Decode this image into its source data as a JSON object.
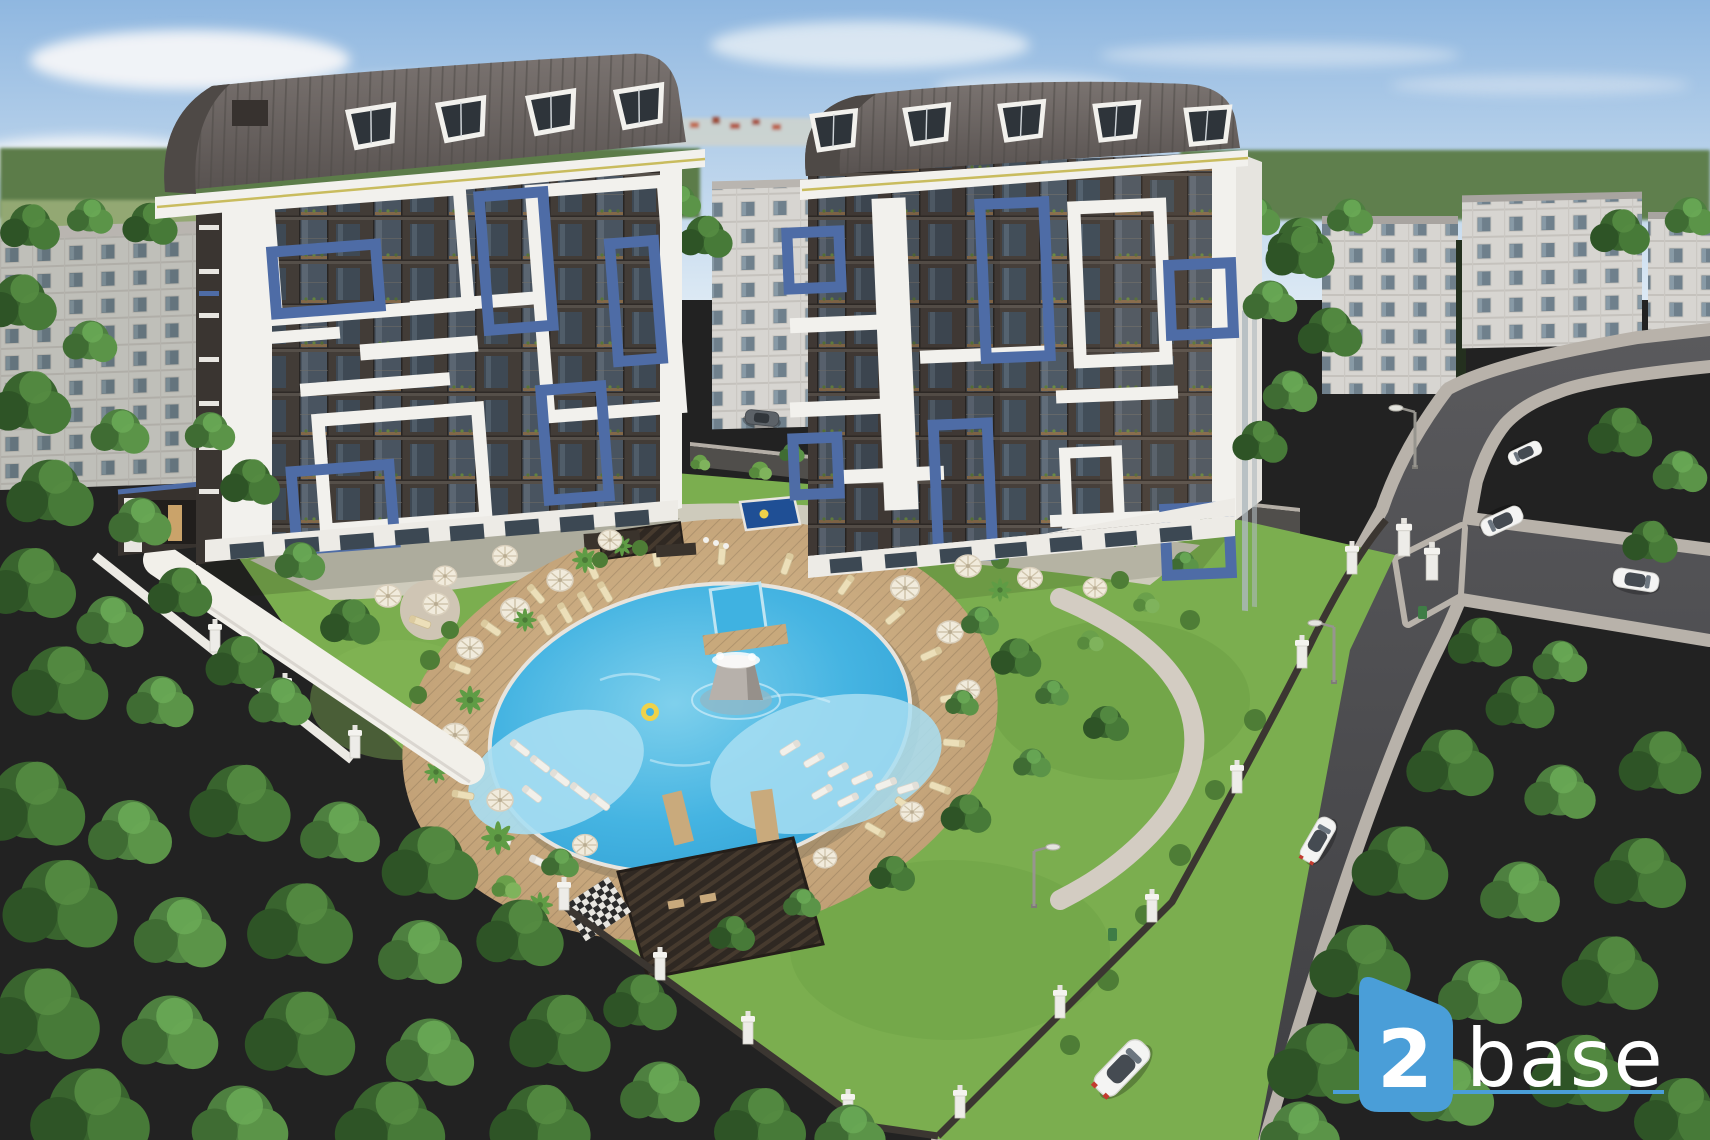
{
  "meta": {
    "description": "Aerial architectural rendering of a modern two-tower apartment complex with dark facades, white and blue balcony frames, barrel roofs, a landscaped courtyard with a circular pool and fountain, surrounded by forest, older white apartment blocks and access roads with cars",
    "type": "3d-render"
  },
  "logo": {
    "number": "2",
    "word": "base"
  },
  "palette": {
    "sky_top": "#8FB7E0",
    "sky_bottom": "#DCE9F4",
    "cloud": "#F4F6F8",
    "forest_dark": "#2E5224",
    "forest_mid": "#3F6E31",
    "forest_light": "#5C9245",
    "lawn": "#7BAE4F",
    "field": "#93A873",
    "facade": "#48413C",
    "facade_shadow": "#332E2A",
    "glass": "#55626E",
    "frame_white": "#F2F1ED",
    "accent_blue": "#4E6CA6",
    "roof": "#6B6360",
    "gold_trim": "#C9BC5E",
    "white_building": "#D8D6D2",
    "window": "#72838F",
    "water": "#2F9FD3",
    "water_light": "#7FD0EC",
    "water_shelf": "#A8DEF2",
    "deck": "#C8A97C",
    "paving": "#D3CCC2",
    "road": "#4A4A4C",
    "sidewalk": "#B8B2AA",
    "wall_dark": "#3B3631",
    "pillar_white": "#EDECE8",
    "car_white": "#F4F4F3",
    "car_red_light": "#C33B2F",
    "bin_green": "#3F7D46",
    "umbrella": "#F1EBDC",
    "lounger": "#ECDFB9",
    "fountain": "#B7B1AB",
    "float_yellow": "#EFD24A",
    "logo_blue": "#4A9ED8",
    "logo_text": "#FFFFFF"
  },
  "scene": {
    "towers": [
      "left-tower",
      "right-tower"
    ],
    "background_buildings": [
      "left-apartment-block",
      "center-apartment-block",
      "right-apartment-block-1",
      "right-apartment-block-2",
      "right-apartment-block-3"
    ],
    "vehicles": [
      "white-car-foreground",
      "white-car-taillights",
      "white-car-upper-road-1",
      "white-car-upper-road-2",
      "white-car-side-road",
      "dark-car-courtyard"
    ],
    "amenities": [
      "circular-pool",
      "central-fountain",
      "kids-pool",
      "pool-deck",
      "sun-loungers",
      "parasols",
      "pergola",
      "cabana",
      "garden",
      "perimeter-wall",
      "street-lamps",
      "litter-bins"
    ]
  }
}
